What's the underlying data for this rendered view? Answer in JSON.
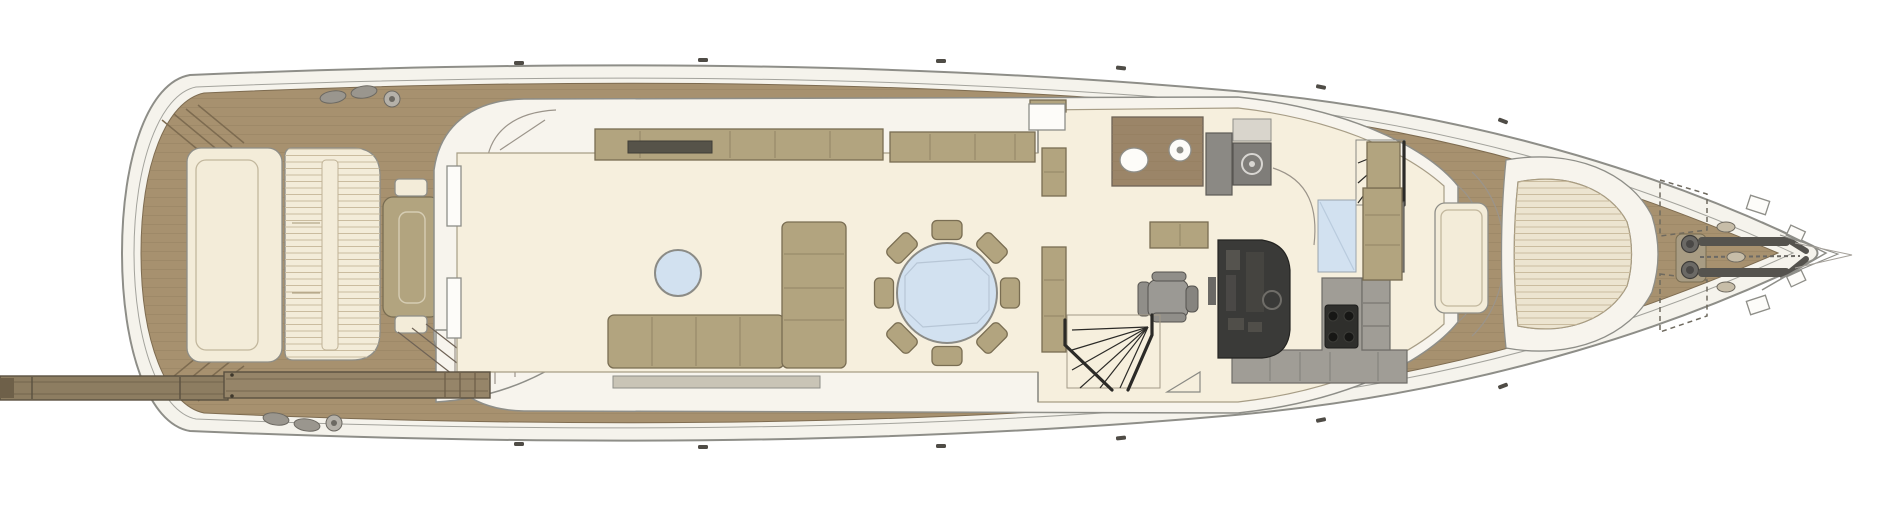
{
  "plan": {
    "kind": "motor-yacht main deck floor plan, top-down view",
    "stern_side": "left",
    "bow_side": "right",
    "areas": [
      {
        "name": "passerelle-gangway"
      },
      {
        "name": "aft-deck"
      },
      {
        "name": "salon"
      },
      {
        "name": "dining-area"
      },
      {
        "name": "day-head"
      },
      {
        "name": "helm-station"
      },
      {
        "name": "galley"
      },
      {
        "name": "foredeck-lounge"
      },
      {
        "name": "bow-ground-tackle"
      }
    ],
    "items": [
      {
        "name": "transom-seat"
      },
      {
        "name": "aft-sunpad-slatted"
      },
      {
        "name": "aft-deck-table"
      },
      {
        "name": "aft-deck-stools",
        "count": 5
      },
      {
        "name": "engine-hatch"
      },
      {
        "name": "corner-boarding-steps",
        "count": 2
      },
      {
        "name": "mooring-cleats"
      },
      {
        "name": "salon-sliding-door"
      },
      {
        "name": "salon-sideboard"
      },
      {
        "name": "tv-cabinet-slot"
      },
      {
        "name": "salon-sofa-l-shaped"
      },
      {
        "name": "coffee-table-round"
      },
      {
        "name": "dining-table-round"
      },
      {
        "name": "dining-chairs",
        "count": 8
      },
      {
        "name": "partition-cabinets"
      },
      {
        "name": "side-deck-door"
      },
      {
        "name": "day-head-toilet"
      },
      {
        "name": "day-head-sink"
      },
      {
        "name": "dumbwaiter-unit"
      },
      {
        "name": "stairs-down-forward"
      },
      {
        "name": "glass-panel"
      },
      {
        "name": "helm-chair"
      },
      {
        "name": "helm-console"
      },
      {
        "name": "companionway-stairs"
      },
      {
        "name": "galley-counter-l"
      },
      {
        "name": "cooktop-4-burner"
      },
      {
        "name": "fridge-cabinet-column"
      },
      {
        "name": "side-deck-stairs"
      },
      {
        "name": "foredeck-sunpad-table"
      },
      {
        "name": "bow-settee-c-shaped"
      },
      {
        "name": "bow-seat-cushion"
      },
      {
        "name": "deck-lockers-dashed",
        "count": 2
      },
      {
        "name": "anchor-windlass",
        "count": 2
      },
      {
        "name": "chain-rails"
      },
      {
        "name": "bow-fairleads"
      },
      {
        "name": "bow-pulpit"
      }
    ]
  },
  "colors": {
    "background": "#ffffff",
    "hull_outline": "#8e8e88",
    "hull_white": "#f5f3ec",
    "teak": "#a7916f",
    "teak_line": "#8f7a5b",
    "teak_dark": "#9b8568",
    "cabin_white": "#f7f4ed",
    "floor_cream": "#f6efdd",
    "furniture_tan": "#b2a47f",
    "furniture_outline": "#796d52",
    "cushion_cream": "#f3ecd9",
    "slat_line": "#cabc9f",
    "table_glass_blue": "#d2e1f0",
    "counter_gray": "#a09d96",
    "equipment_gray": "#8b8984",
    "console_dark": "#3a3a38",
    "hob_black": "#2f2f2c",
    "stair_line": "#2b2a27",
    "passerelle_wood": "#8d7d61"
  }
}
